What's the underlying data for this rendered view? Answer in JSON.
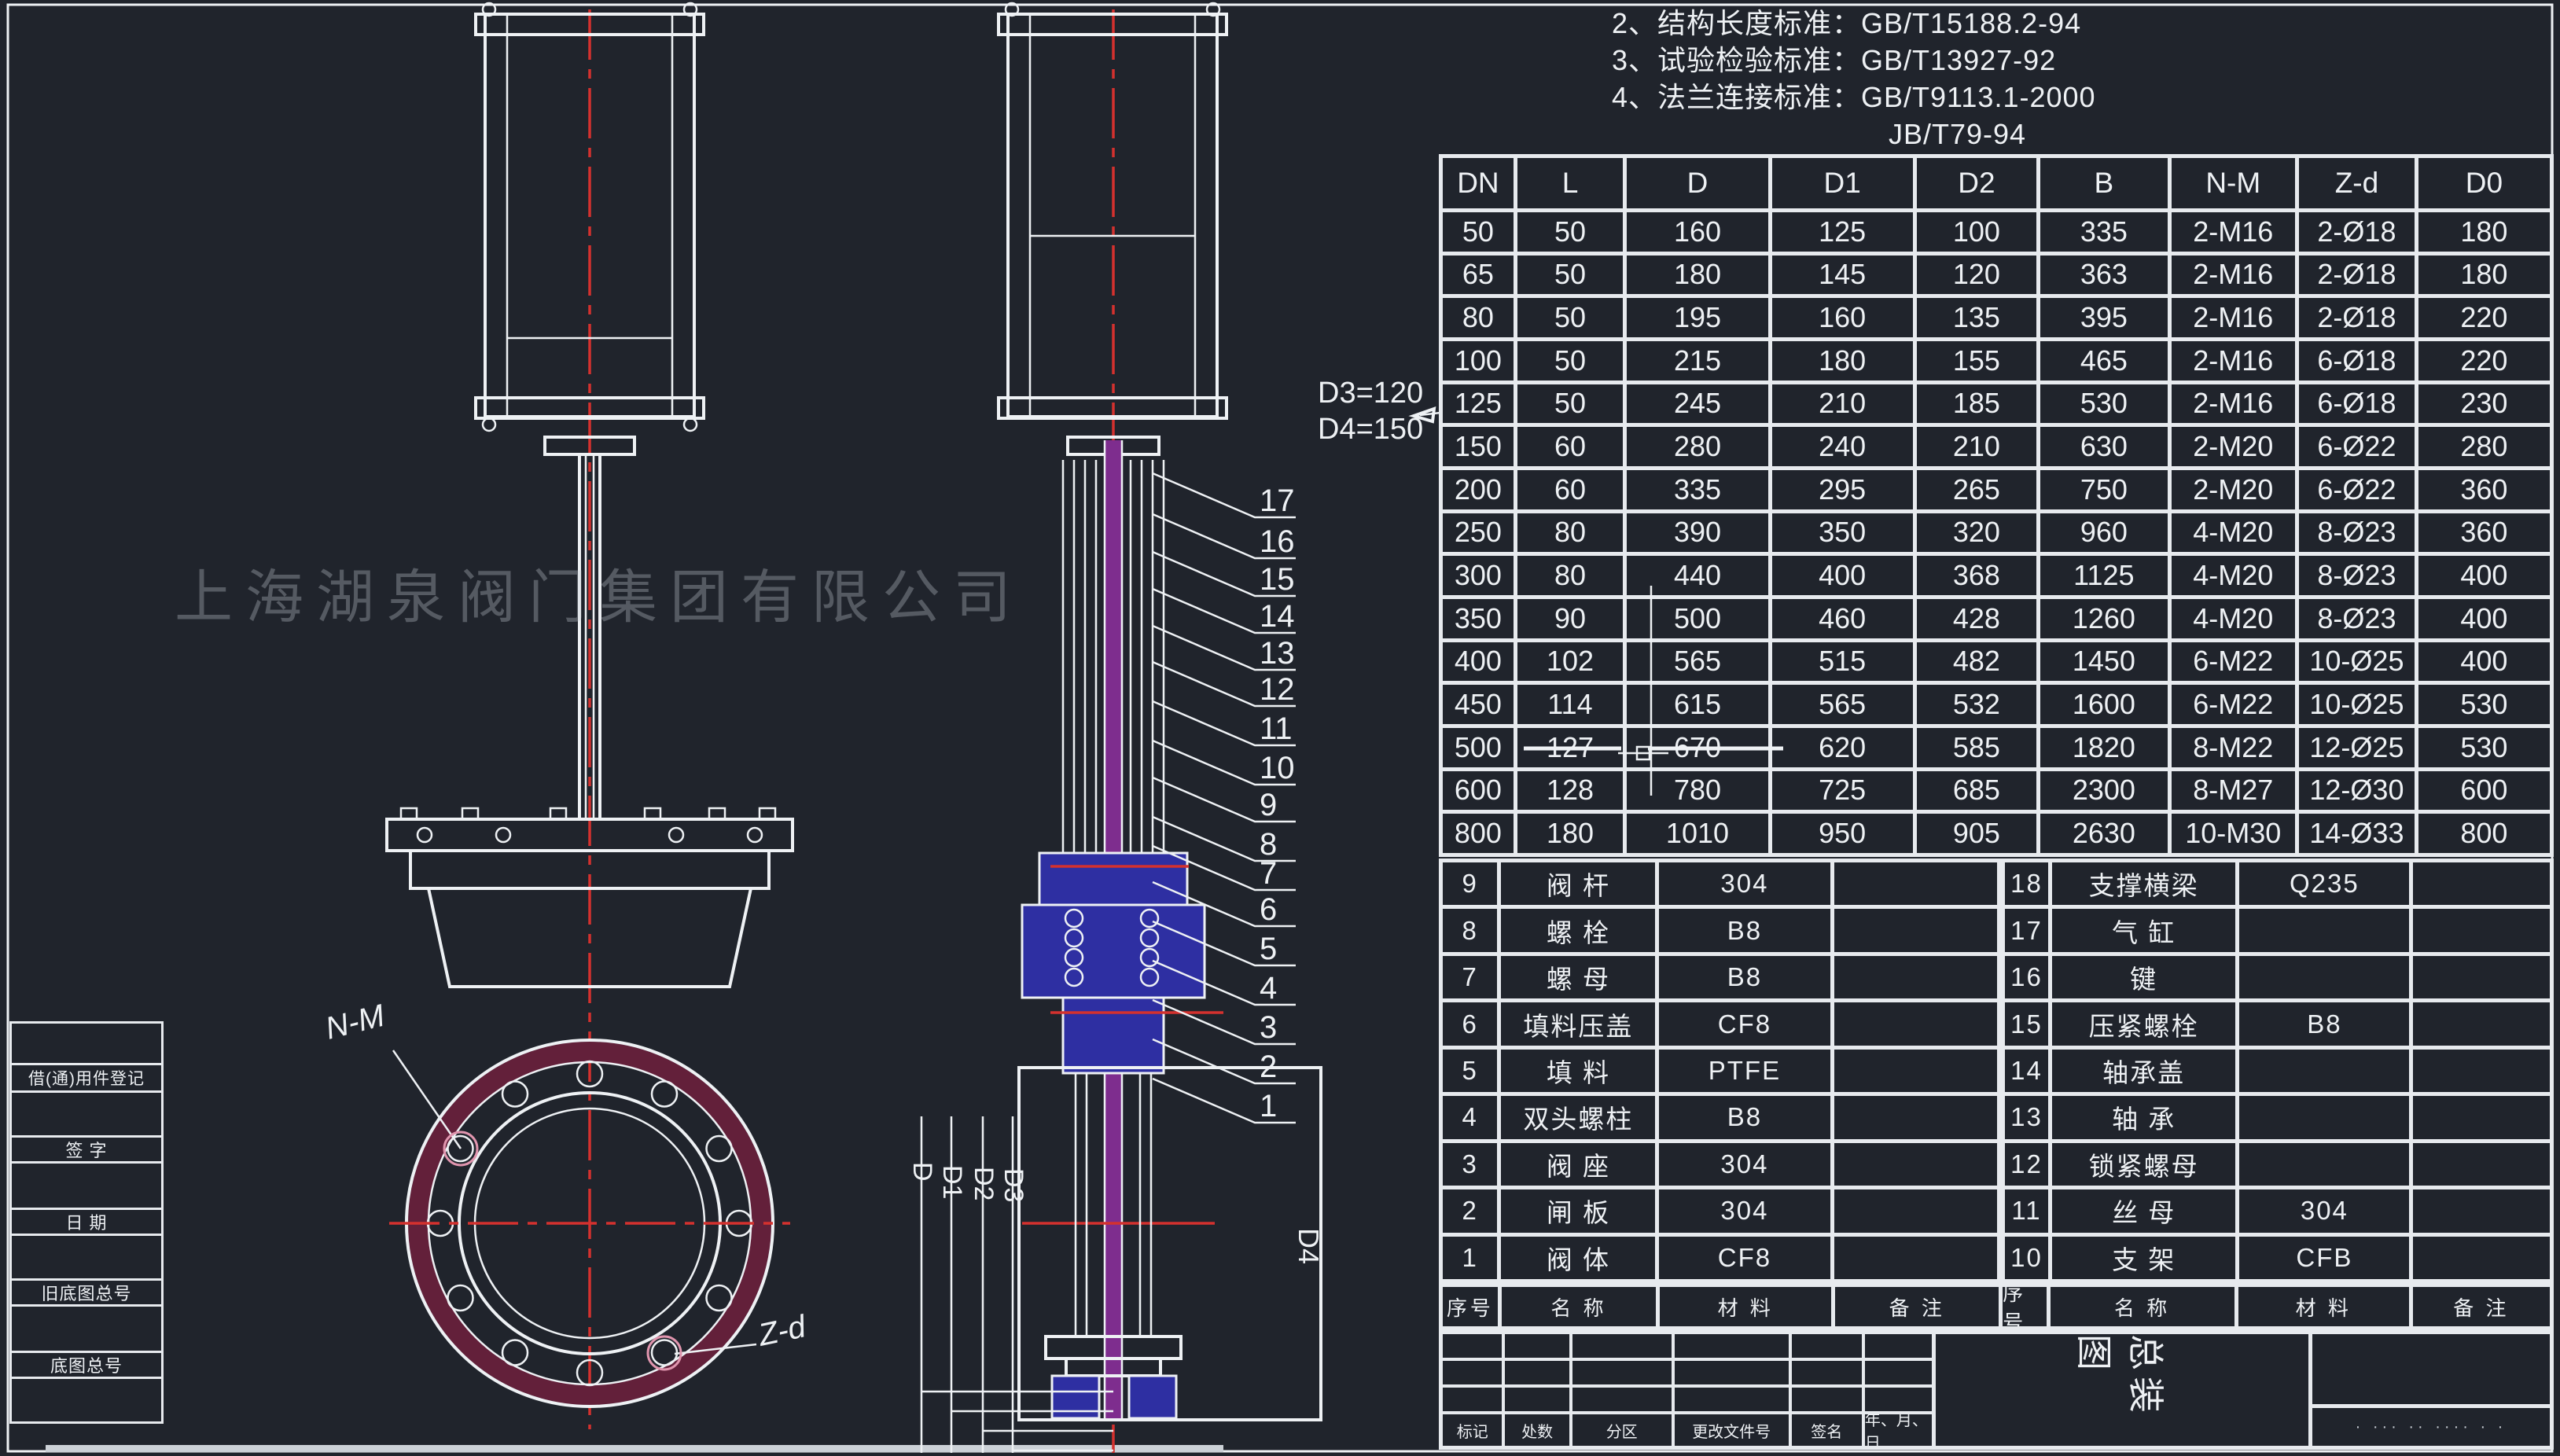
{
  "watermark": "上海湖泉阀门集团有限公司",
  "colors": {
    "background": "#20242c",
    "line": "#eef1f4",
    "grid_line": "#e7eaee",
    "centerline_red": "#d4312e",
    "flange_maroon": "#63203a",
    "section_blue": "#2e2fa2",
    "stem_purple": "#7e2d8e"
  },
  "notes": {
    "lines": [
      "2、结构长度标准：GB/T15188.2-94",
      "3、试验检验标准：GB/T13927-92",
      "4、法兰连接标准：GB/T9113.1-2000",
      "JB/T79-94"
    ]
  },
  "annotations": {
    "d3": "D3=120",
    "d4": "D4=150",
    "nm": "N-M",
    "zd": "Z-d",
    "dims": [
      "D",
      "D1",
      "D2",
      "D3",
      "D4"
    ],
    "callouts": [
      "17",
      "16",
      "15",
      "14",
      "13",
      "12",
      "11",
      "10",
      "9",
      "8",
      "7",
      "6",
      "5",
      "4",
      "3",
      "2",
      "1"
    ]
  },
  "dim_table": {
    "headers": [
      "DN",
      "L",
      "D",
      "D1",
      "D2",
      "B",
      "N-M",
      "Z-d",
      "D0"
    ],
    "rows": [
      [
        "50",
        "50",
        "160",
        "125",
        "100",
        "335",
        "2-M16",
        "2-Ø18",
        "180"
      ],
      [
        "65",
        "50",
        "180",
        "145",
        "120",
        "363",
        "2-M16",
        "2-Ø18",
        "180"
      ],
      [
        "80",
        "50",
        "195",
        "160",
        "135",
        "395",
        "2-M16",
        "2-Ø18",
        "220"
      ],
      [
        "100",
        "50",
        "215",
        "180",
        "155",
        "465",
        "2-M16",
        "6-Ø18",
        "220"
      ],
      [
        "125",
        "50",
        "245",
        "210",
        "185",
        "530",
        "2-M16",
        "6-Ø18",
        "230"
      ],
      [
        "150",
        "60",
        "280",
        "240",
        "210",
        "630",
        "2-M20",
        "6-Ø22",
        "280"
      ],
      [
        "200",
        "60",
        "335",
        "295",
        "265",
        "750",
        "2-M20",
        "6-Ø22",
        "360"
      ],
      [
        "250",
        "80",
        "390",
        "350",
        "320",
        "960",
        "4-M20",
        "8-Ø23",
        "360"
      ],
      [
        "300",
        "80",
        "440",
        "400",
        "368",
        "1125",
        "4-M20",
        "8-Ø23",
        "400"
      ],
      [
        "350",
        "90",
        "500",
        "460",
        "428",
        "1260",
        "4-M20",
        "8-Ø23",
        "400"
      ],
      [
        "400",
        "102",
        "565",
        "515",
        "482",
        "1450",
        "6-M22",
        "10-Ø25",
        "400"
      ],
      [
        "450",
        "114",
        "615",
        "565",
        "532",
        "1600",
        "6-M22",
        "10-Ø25",
        "530"
      ],
      [
        "500",
        "127",
        "670",
        "620",
        "585",
        "1820",
        "8-M22",
        "12-Ø25",
        "530"
      ],
      [
        "600",
        "128",
        "780",
        "725",
        "685",
        "2300",
        "8-M27",
        "12-Ø30",
        "600"
      ],
      [
        "800",
        "180",
        "1010",
        "950",
        "905",
        "2630",
        "10-M30",
        "14-Ø33",
        "800"
      ]
    ]
  },
  "parts_header_left": [
    "序号",
    "名 称",
    "材 料",
    "备 注"
  ],
  "parts_header_right": [
    "序号",
    "名 称",
    "材 料",
    "备 注"
  ],
  "parts_left": [
    {
      "no": "9",
      "name": "阀 杆",
      "material": "304"
    },
    {
      "no": "8",
      "name": "螺 栓",
      "material": "B8"
    },
    {
      "no": "7",
      "name": "螺 母",
      "material": "B8"
    },
    {
      "no": "6",
      "name": "填料压盖",
      "material": "CF8"
    },
    {
      "no": "5",
      "name": "填 料",
      "material": "PTFE"
    },
    {
      "no": "4",
      "name": "双头螺柱",
      "material": "B8"
    },
    {
      "no": "3",
      "name": "阀 座",
      "material": "304"
    },
    {
      "no": "2",
      "name": "闸 板",
      "material": "304"
    },
    {
      "no": "1",
      "name": "阀 体",
      "material": "CF8"
    }
  ],
  "parts_right": [
    {
      "no": "18",
      "name": "支撑横梁",
      "material": "Q235"
    },
    {
      "no": "17",
      "name": "气 缸",
      "material": ""
    },
    {
      "no": "16",
      "name": "键",
      "material": ""
    },
    {
      "no": "15",
      "name": "压紧螺栓",
      "material": "B8"
    },
    {
      "no": "14",
      "name": "轴承盖",
      "material": ""
    },
    {
      "no": "13",
      "name": "轴 承",
      "material": ""
    },
    {
      "no": "12",
      "name": "锁紧螺母",
      "material": ""
    },
    {
      "no": "11",
      "name": "丝 母",
      "material": "304"
    },
    {
      "no": "10",
      "name": "支 架",
      "material": "CFB"
    }
  ],
  "title_block": {
    "title": "总装图",
    "revision_labels": [
      "标记",
      "处数",
      "分区",
      "更改文件号",
      "签名",
      "年、月、日"
    ],
    "stamp": "· ··· ·· ···· · ·"
  },
  "margin": {
    "labels": [
      "借(通)用件登记",
      "签 字",
      "日 期",
      "旧底图总号",
      "底图总号"
    ]
  }
}
